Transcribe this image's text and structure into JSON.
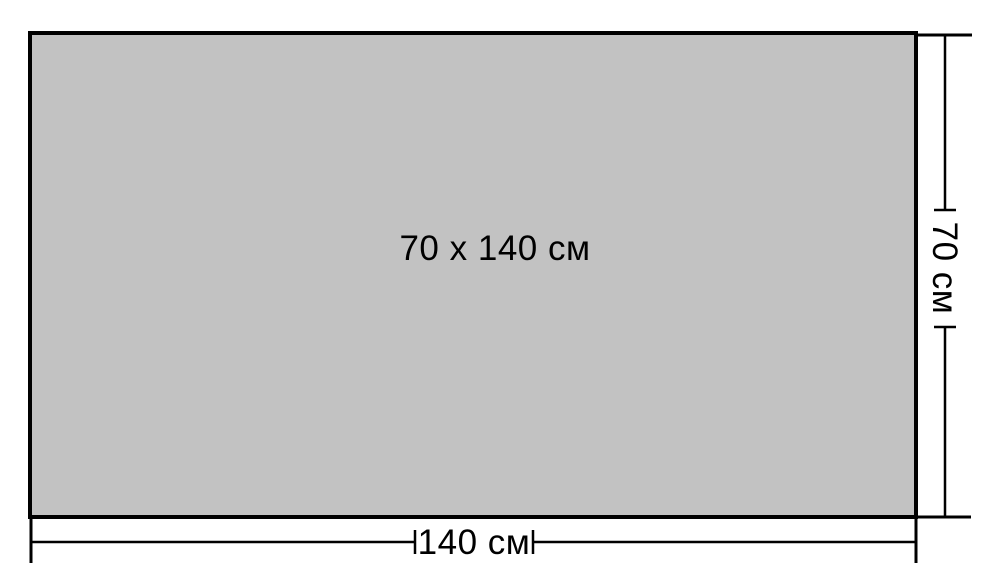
{
  "diagram": {
    "title_label": "70 x 140 см",
    "width_label": "140 см",
    "height_label": "70 см",
    "fill_color": "#c2c2c2",
    "line_color": "#000000",
    "background_color": "#ffffff"
  }
}
